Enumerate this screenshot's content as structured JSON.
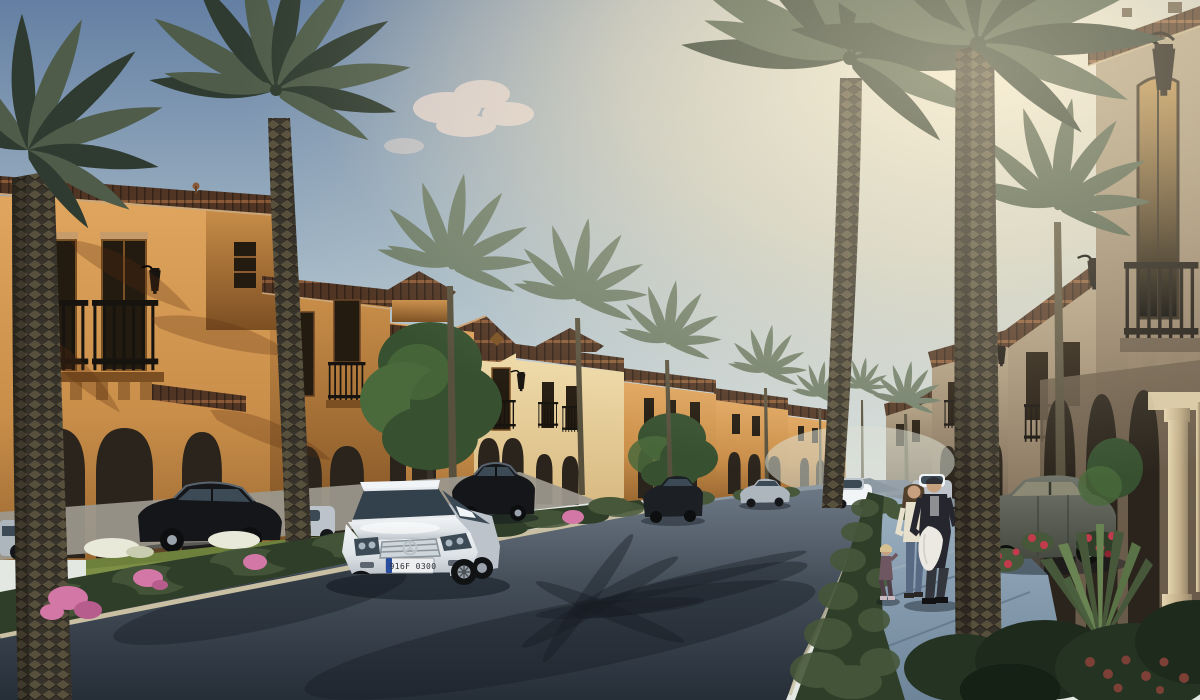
{
  "meta": {
    "title": "Mediterranean villa community street - architectural rendering",
    "render_type": "photorealistic 3D exterior visualization at sunset"
  },
  "scene": {
    "description": "Palm-lined residential street with two-storey Mediterranean villas, terracotta roofs, wrought-iron balconies, parked cars and a family walking on the sidewalk at dusk",
    "time_of_day": "sunset",
    "license_plate": "916F 0300",
    "people": [
      {
        "name": "man",
        "appearance": "dark jacket over grey shirt, dark cap, carrying a white coat"
      },
      {
        "name": "woman",
        "appearance": "cream blouse, blue jeans, long brown hair"
      },
      {
        "name": "child",
        "appearance": "small blonde girl in mauve outfit"
      }
    ],
    "vehicles": [
      {
        "name": "white-mercedes-sedan",
        "color": "white",
        "position": "foreground centre of street"
      },
      {
        "name": "black-sedan",
        "color": "black",
        "position": "parked in left driveway"
      },
      {
        "name": "white-compact",
        "color": "white",
        "position": "behind palm trunk, left"
      },
      {
        "name": "black-car-mid",
        "color": "black",
        "position": "mid-street left side"
      },
      {
        "name": "dark-car-right",
        "color": "dark grey",
        "position": "mid-street right side"
      },
      {
        "name": "silver-sedan-distant",
        "color": "silver",
        "position": "distant left kerb"
      },
      {
        "name": "white-car-distant",
        "color": "white",
        "position": "near street end"
      },
      {
        "name": "white-hatchback",
        "color": "white",
        "position": "behind the family"
      },
      {
        "name": "olive-sedan",
        "color": "olive grey",
        "position": "parked by right colonnade"
      }
    ],
    "vegetation": {
      "palms": "tall date palms lining both sides of the street",
      "hedge": "low clipped hedge along the left kerb with pink bougainvillea",
      "flowers": [
        "pink",
        "red",
        "white"
      ],
      "trees": "green deciduous trees between villas",
      "yucca": "spiky yucca beside the right walkway"
    },
    "architecture": {
      "style": "Mediterranean / Andalusian villas",
      "features": [
        "terracotta tile roof bands",
        "wrought-iron Juliet balconies",
        "arched porches and doorways",
        "black wall lanterns",
        "stone porch columns",
        "corbelled balcony slabs"
      ]
    }
  },
  "palette": {
    "sky_top": "#647fa3",
    "sky_mid": "#a3b7c5",
    "sky_low": "#e3e8e3",
    "sky_glow": "#fff3d6",
    "cloud": "#ecd9cf",
    "haze": "#d9ded4",
    "wall_lit": "#e0a55e",
    "wall_mid": "#c98e49",
    "wall_shade": "#9a6832",
    "wall_deep": "#7c4f22",
    "cream_lit": "#eed9a8",
    "cream_mid": "#d8ba82",
    "roof_dark": "#503524",
    "roof_lit": "#8a5a38",
    "roof_edge": "#c79b6a",
    "win_dark": "#231a10",
    "frame_brown": "#7a5124",
    "rail": "#17130f",
    "taupe_lit": "#b2a084",
    "taupe_mid": "#8f7d66",
    "taupe_shade": "#685a49",
    "porch_deep": "#2a241c",
    "column_lit": "#e3d4ae",
    "column_shade": "#97876a",
    "road_far": "#6e7a87",
    "road_mid": "#454f5a",
    "road_near": "#262e38",
    "curb": "#c9c0a3",
    "walk_lit": "#9cb1c1",
    "walk_shade": "#6e8499",
    "pave": "#9b978c",
    "lawn": "#7c8f45",
    "lawn_dark": "#5f7433",
    "hedge": "#2f3e29",
    "hedge_lit": "#46573a",
    "leaf_tree": "#365030",
    "leaf_tree_lit": "#4a6a3c",
    "frond_lit": "#4e5c49",
    "frond_dark": "#2f3b30",
    "frond_pale": "#6f7e6a",
    "trunk_lit": "#57503d",
    "trunk_dark": "#37332a",
    "flower_pink": "#d377a6",
    "flower_red": "#c13b4b",
    "flower_white": "#e9e9da",
    "flower_rust": "#7c4036",
    "car_white": "#f2f5f7",
    "car_white_shade": "#bcc3ca",
    "glass": "#3c4a56",
    "car_black": "#141619",
    "car_silver": "#adb6bd",
    "car_olive": "#70746a",
    "rim": "#9aa3ab",
    "plate_bg": "#eceef0",
    "plate_blue": "#2a4da0",
    "plate_text": "#2c2f35",
    "skin": "#c7a07f",
    "hair_brown": "#52402c",
    "hair_blond": "#d6c08f",
    "jacket": "#26262e",
    "shirt": "#8d8f92",
    "coat": "#ece9e2",
    "blouse": "#e7e0cd",
    "jeans": "#586983",
    "child_outfit": "#6e5760",
    "pants_dark": "#33363c",
    "shadow_col": "rgba(14,19,27,0.42)"
  }
}
